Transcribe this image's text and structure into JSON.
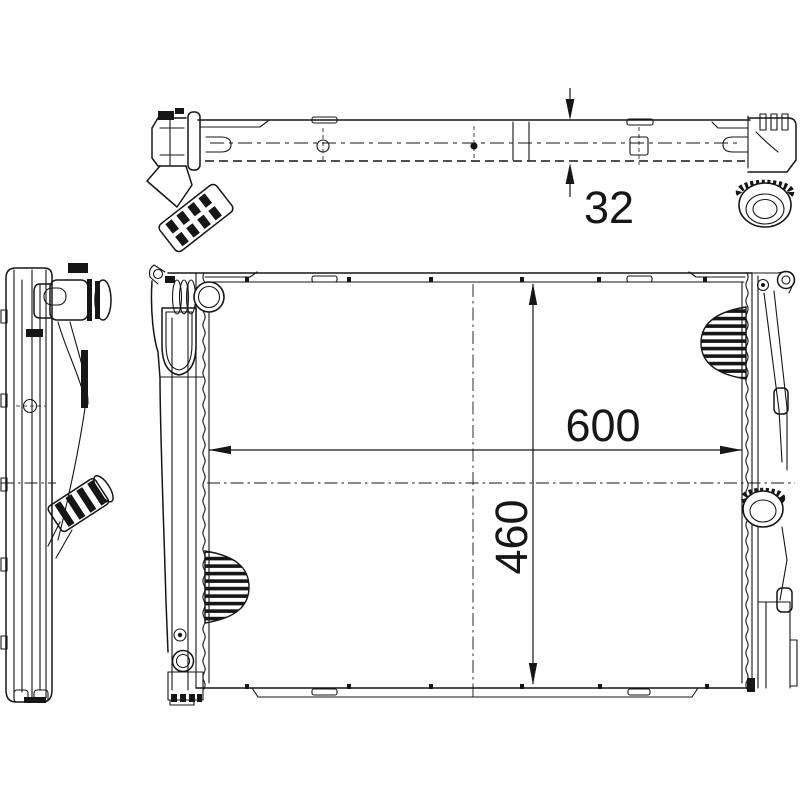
{
  "drawing": {
    "labels": {
      "depth": "32",
      "width": "600",
      "height": "460"
    },
    "colors": {
      "background": "#ffffff",
      "ink": "#161616"
    }
  }
}
